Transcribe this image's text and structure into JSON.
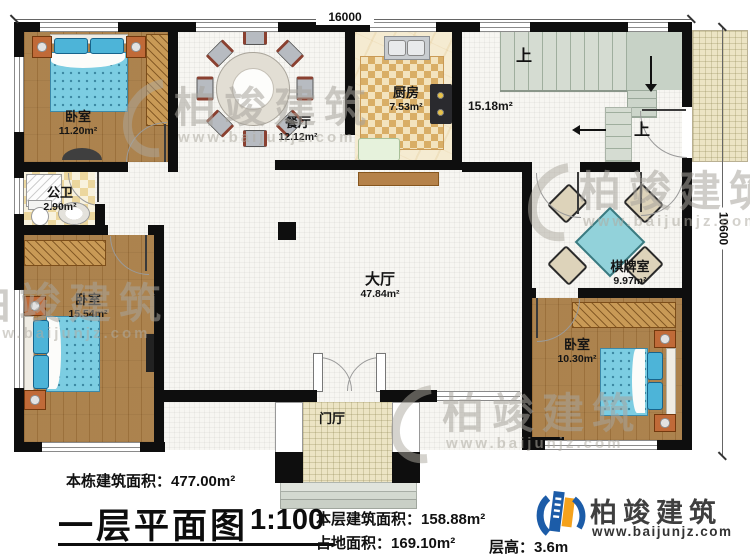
{
  "dimensions": {
    "top": "16000",
    "right": "10600"
  },
  "stairs": {
    "up1": "上",
    "up2": "上"
  },
  "rooms": {
    "bedroom1": {
      "name": "卧室",
      "area": "11.20m²"
    },
    "dining": {
      "name": "餐厅",
      "area": "12.12m²"
    },
    "kitchen": {
      "name": "厨房",
      "area": "7.53m²"
    },
    "stair_hall": {
      "area": "15.18m²"
    },
    "bathroom": {
      "name": "公卫",
      "area": "2.90m²"
    },
    "bedroom2": {
      "name": "卧室",
      "area": "15.54m²"
    },
    "hall": {
      "name": "大厅",
      "area": "47.84m²"
    },
    "mahjong_room": {
      "name": "棋牌室",
      "area": "9.97m²"
    },
    "bedroom3": {
      "name": "卧室",
      "area": "10.30m²"
    },
    "foyer": {
      "name": "门厅"
    }
  },
  "footer": {
    "building_area_label": "本栋建筑面积：",
    "building_area_value": "477.00m²",
    "title": "一层平面图",
    "scale": "1:100",
    "floor_area_label": "本层建筑面积：",
    "floor_area_value": "158.88m²",
    "land_area_label": "占地面积：",
    "land_area_value": "169.10m²",
    "floor_height_label": "层高：",
    "floor_height_value": "3.6m"
  },
  "logo": {
    "brand": "柏竣建筑",
    "url": "www.baijunjz.com",
    "blue": "#1c5ca8",
    "orange": "#f5a21c"
  },
  "watermark": {
    "brand": "柏竣建筑",
    "url": "www.baijunjz.com"
  }
}
